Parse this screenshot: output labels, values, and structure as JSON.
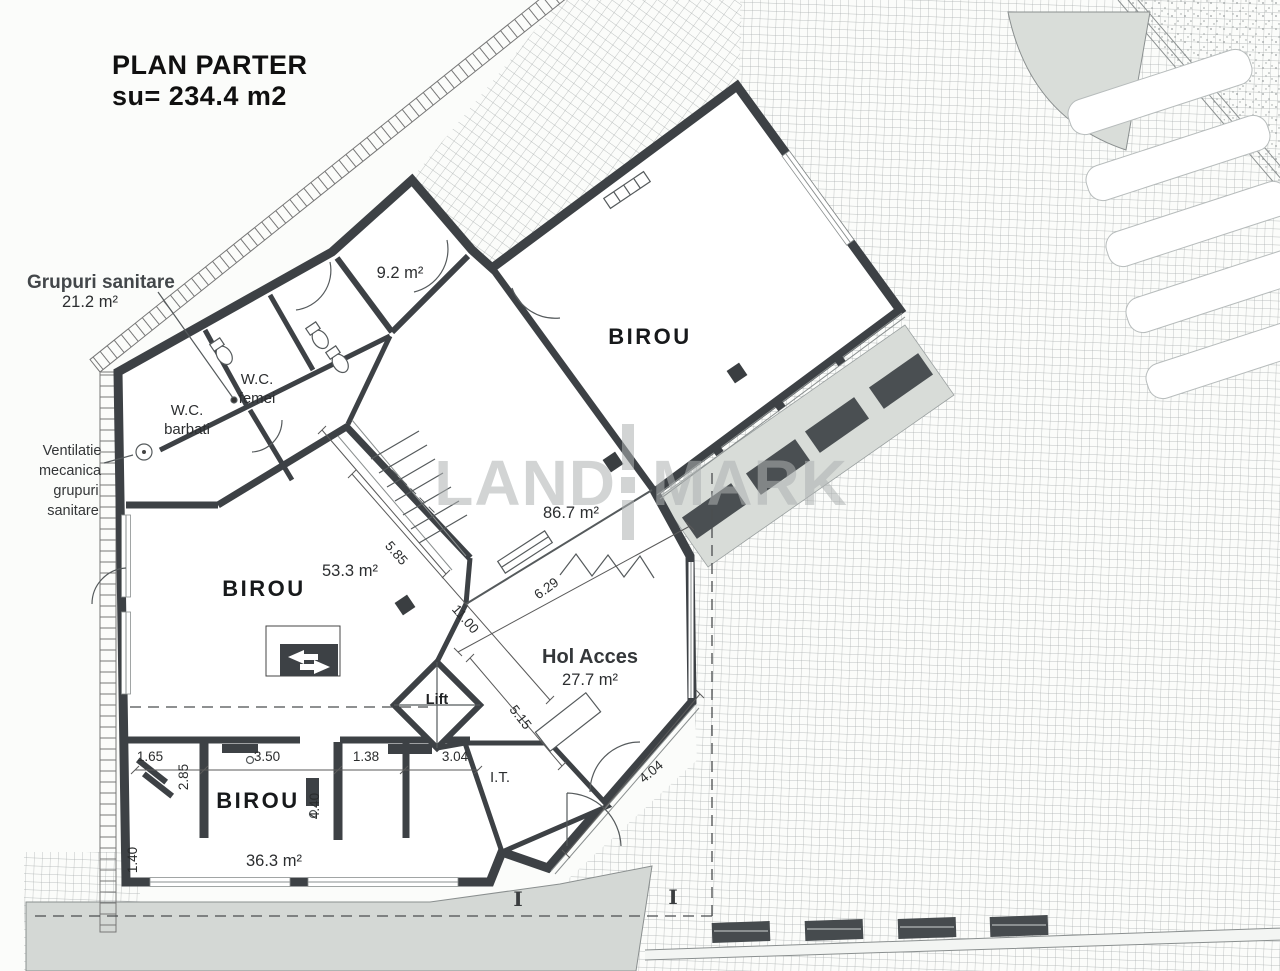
{
  "title": {
    "line1": "PLAN PARTER",
    "line2": "su= 234.4 m2"
  },
  "annotations": {
    "grupuri": {
      "label": "Grupuri sanitare",
      "area": "21.2 m²"
    },
    "ventilatie": {
      "line1": "Ventilatie",
      "line2": "mecanica",
      "line3": "grupuri",
      "line4": "sanitare"
    }
  },
  "rooms": {
    "birou_mare": {
      "label": "BIROU",
      "area": "86.7 m²"
    },
    "birou_mijloc": {
      "label": "BIROU",
      "area": "53.3 m²"
    },
    "birou_jos": {
      "label": "BIROU",
      "area": "36.3 m²"
    },
    "hol_acces": {
      "label": "Hol Acces",
      "area": "27.7 m²"
    },
    "camera_mica": {
      "area": "9.2 m²"
    },
    "wc_femei": {
      "line1": "W.C.",
      "line2": "femei"
    },
    "wc_barbati": {
      "line1": "W.C.",
      "line2": "barbati"
    },
    "lift": {
      "label": "Lift"
    },
    "it": {
      "label": "I.T."
    }
  },
  "dimensions": {
    "stair_width": "5.85",
    "hall_length": "11.00",
    "hol_edge_ne": "6.29",
    "hol_edge_sw": "5.15",
    "entrance_edge": "4.04",
    "it_width": "3.04",
    "seg_1": "1.65",
    "seg_2": "3.50",
    "seg_3": "1.38",
    "left_1": "2.85",
    "left_2": "1.40",
    "desk_wall": "4.40"
  },
  "section_markers": {
    "left": "I",
    "right": "I"
  },
  "watermark": {
    "left": "LAND",
    "right": "MARK"
  },
  "colors": {
    "wall": "#3d4145",
    "paper": "#fbfcfa",
    "grid_line": "#a9aeae",
    "walkway": "#d4d8d5",
    "watermark": "#aeb2b2"
  }
}
